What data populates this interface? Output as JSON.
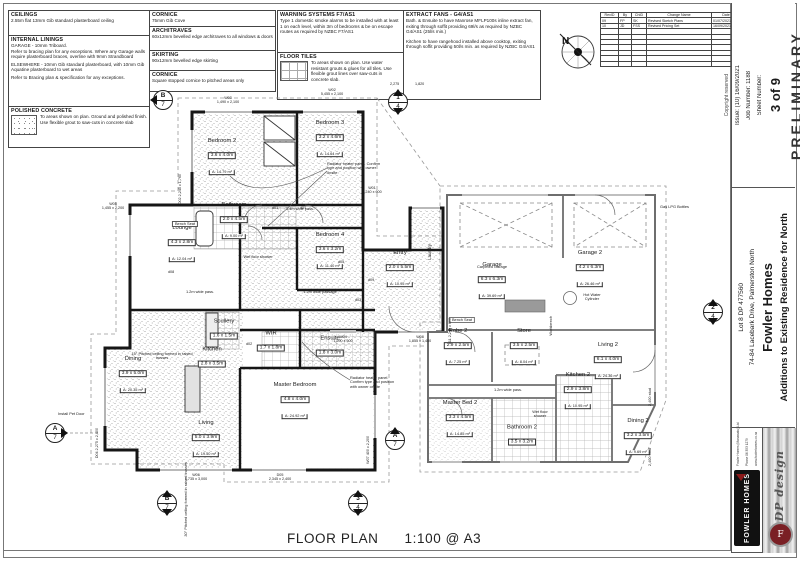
{
  "plan": {
    "title": "FLOOR PLAN",
    "scale": "1:100 @ A3"
  },
  "north": "N",
  "notes": {
    "ceilings": {
      "title": "CEILINGS",
      "body": "2.55m flat 13mm Gib standard plasterboard ceiling"
    },
    "internal_linings": {
      "title": "INTERNAL LININGS",
      "body1": "GARAGE - 10mm Triboard.",
      "body2": "Refer to bracing plan for any exceptions. Where any Garage walls require plasterboard braces, overline with 9mm Strandboard",
      "body3": "ELSEWHERE - 10mm Gib standard plasterboard, with 10mm Gib Aquatine plasterboard to wet areas",
      "body4": "Refer to Bracing plan & specification for any exceptions."
    },
    "polished_concrete": {
      "title": "POLISHED CONCRETE",
      "body": "To areas shown on plan. Ground and polished finish. Use flexible grout to saw-cuts in concrete slab"
    },
    "cornice1": {
      "title": "CORNICE",
      "body": "75mm Gib Cove"
    },
    "architraves": {
      "title": "ARCHITRAVES",
      "body": "60x12mm bevelled edge architraves to all windows & doors"
    },
    "skirting": {
      "title": "SKIRTING",
      "body": "90x12mm bevelled edge skirting"
    },
    "cornice2": {
      "title": "CORNICE",
      "body": "Square stopped cornice to pitched areas only"
    },
    "warning_systems": {
      "title": "WARNING SYSTEMS F7/AS1",
      "body": "Type 1 domestic smoke alarms to be installed with at least 1 on each level, within 3m of bedrooms & be on escape routes as required by NZBC F7/AS1"
    },
    "floor_tiles": {
      "title": "FLOOR TILES",
      "body": "To areas shown on plan. Use water resistant grouts & glues for all tiles. Use flexible grout lines over saw-cuts in concrete slab."
    },
    "extract_fans": {
      "title": "EXTRACT FANS - G4/AS1",
      "body1": "Bath. & Ensuite to have Manrose MFLP100s inline extract fan, exiting through soffit providing 69l/s as required by NZBC G4/AS1 (25l/s min.)",
      "body2": "Kitchen to have rangehood installed above cooktop, exiting through soffit providing 50l/s min. as required by NZBC G4/AS1"
    }
  },
  "revisions": {
    "headers": [
      "RevID",
      "By",
      "ChID",
      "Change Name",
      "Date"
    ],
    "rows": [
      {
        "id": "09",
        "by": "FP",
        "ch": "SK",
        "name": "Revised Sketch Plans",
        "date": "01/07/2021"
      },
      {
        "id": "10",
        "by": "JD",
        "ch": "FSS",
        "name": "Revised Pricing Set",
        "date": "16/09/2021"
      }
    ]
  },
  "titleblock": {
    "preliminary": "PRELIMINARY",
    "copyright": "Copyright reserved",
    "sheet_label": "Sheet Number:",
    "sheet_value": "3 of 9",
    "issue": "Issue:  (10) 16/09/2021",
    "job": "Job Number:   1188",
    "project": "Additions to Existing Residence for North",
    "client": "Fowler Homes",
    "address": "74-84 Lacebark Drive, Palmerston North",
    "lot": "Lot 8 DP 477560",
    "brand": "FOWLER HOMES",
    "adp": "ADP design",
    "adp_monogram": "F",
    "contact1": "Fowler Homes (Manawatu) Ltd",
    "contact2": "Phone 06 353 1279",
    "contact3": "www.fowlerhomes.co.nz"
  },
  "rooms": [
    {
      "name": "Bedroom 2",
      "dims": "3.6 x 4.0m",
      "area": "A: 14.79 m²"
    },
    {
      "name": "Bedroom 3",
      "dims": "3.2 x 4.6m",
      "area": "A: 14.64 m²"
    },
    {
      "name": "Bedroom 4",
      "dims": "3.6 x 3.2m",
      "area": "A: 11.40 m²"
    },
    {
      "name": "Bathroom",
      "dims": "2.0 x 4.5m",
      "area": "A: 9.00 m²"
    },
    {
      "name": "Lounge",
      "dims": "4.3 x 2.8m",
      "area": "A: 12.04 m²"
    },
    {
      "name": "Scullery",
      "dims": "1.6 x 1.5m",
      "area": ""
    },
    {
      "name": "Kitchen",
      "dims": "2.8 x 3.5m",
      "area": ""
    },
    {
      "name": "Dining",
      "dims": "3.9 x 5.0m",
      "area": "A: 20.35 m²"
    },
    {
      "name": "Living",
      "dims": "5.0 x 3.9m",
      "area": "A: 19.50 m²"
    },
    {
      "name": "Master Bedroom",
      "dims": "4.8 x 4.0m",
      "area": "A: 24.92 m²"
    },
    {
      "name": "WIR",
      "dims": "1.7 x 1.8m",
      "area": ""
    },
    {
      "name": "Ensuite",
      "dims": "1.8 x 3.0m",
      "area": ""
    },
    {
      "name": "Entry",
      "dims": "2.0 x 5.5m",
      "area": "A: 10.95 m²"
    },
    {
      "name": "Laundry",
      "dims": "",
      "area": ""
    },
    {
      "name": "Garage",
      "dims": "6.3 x 6.3m",
      "area": "A: 39.69 m²"
    },
    {
      "name": "Garage 2",
      "dims": "4.2 x 6.3m",
      "area": "A: 26.46 m²"
    },
    {
      "name": "Robe 2",
      "dims": "2.9 x 2.5m",
      "area": "A: 7.25 m²"
    },
    {
      "name": "Store",
      "dims": "3.5 x 2.5m",
      "area": "A: 8.04 m²"
    },
    {
      "name": "Living 2",
      "dims": "6.1 x 4.0m",
      "area": "A: 24.36 m²"
    },
    {
      "name": "Kitchen 2",
      "dims": "2.9 x 3.8m",
      "area": "A: 10.95 m²"
    },
    {
      "name": "Master Bed 2",
      "dims": "3.3 x 4.5m",
      "area": "A: 14.85 m²"
    },
    {
      "name": "Bathroom 2",
      "dims": "3.5 x 3.2m",
      "area": ""
    },
    {
      "name": "Dining 2",
      "dims": "3.2 x 3.5m",
      "area": "A: 9.69 m²"
    }
  ],
  "annotations": {
    "radiator": "Radiator heater panel. Confirm type and position with owner onsite",
    "gas": "Gas LPG Bottles",
    "pet_door": "Install Pet Door",
    "bench_seat": "Bench Seat",
    "pass_14": "1.4m wide pass.",
    "pass_12": "1.2m wide pass.",
    "passage_12": "1.2m wide passage",
    "wet_floor": "Wet floor shower",
    "pitch_15": "15° Pitched ceiling formed in raised trusses",
    "pitch_30": "30° Pitched ceiling formed in raised trusses",
    "hwc": "Hot Water Cylinder",
    "workbench": "Workbench",
    "carpeted": "Carpeted Garage",
    "stud": "2,400 stud"
  },
  "openings": {
    "w01": {
      "tag": "W01",
      "dims": "3,240 x 600"
    },
    "w02": {
      "tag": "W02",
      "dims": "5,455 x 2,100"
    },
    "w03": {
      "tag": "W03",
      "dims": "1,490 x 2,100"
    },
    "w04": {
      "tag": "W04",
      "dims": "1,290 x 600"
    },
    "w05": {
      "tag": "W05",
      "dims": "1,455 x 2,200"
    },
    "w06": {
      "tag": "W06",
      "dims": "1,735 x 3,000"
    },
    "w07": {
      "tag": "W07",
      "dims": "400 x 2,200"
    },
    "w08": {
      "tag": "W08",
      "dims": "1,855 x 1,400"
    },
    "d02": {
      "tag": "D02",
      "dims": "2,245 x 1,760"
    },
    "d04": {
      "tag": "D04",
      "dims": "2,275 x 2,400"
    },
    "d05": {
      "tag": "D05",
      "dims": "2,345 x 2,400"
    },
    "d11": {
      "tag": "d11",
      "dims": "2,245 x 600"
    }
  },
  "door_tags": {
    "d01": "d01",
    "d02": "d02",
    "d03": "d03",
    "d05": "d05",
    "d08": "d08",
    "d09": "d09"
  },
  "dims_top": {
    "a": "2,275",
    "b": "1,820"
  },
  "markers": {
    "b7": {
      "top": "B",
      "bottom": "7"
    },
    "a7": {
      "top": "A",
      "bottom": "7"
    },
    "m14": {
      "top": "1",
      "bottom": "4"
    },
    "m24": {
      "top": "2",
      "bottom": "4"
    },
    "m34": {
      "top": "3",
      "bottom": "4"
    }
  }
}
